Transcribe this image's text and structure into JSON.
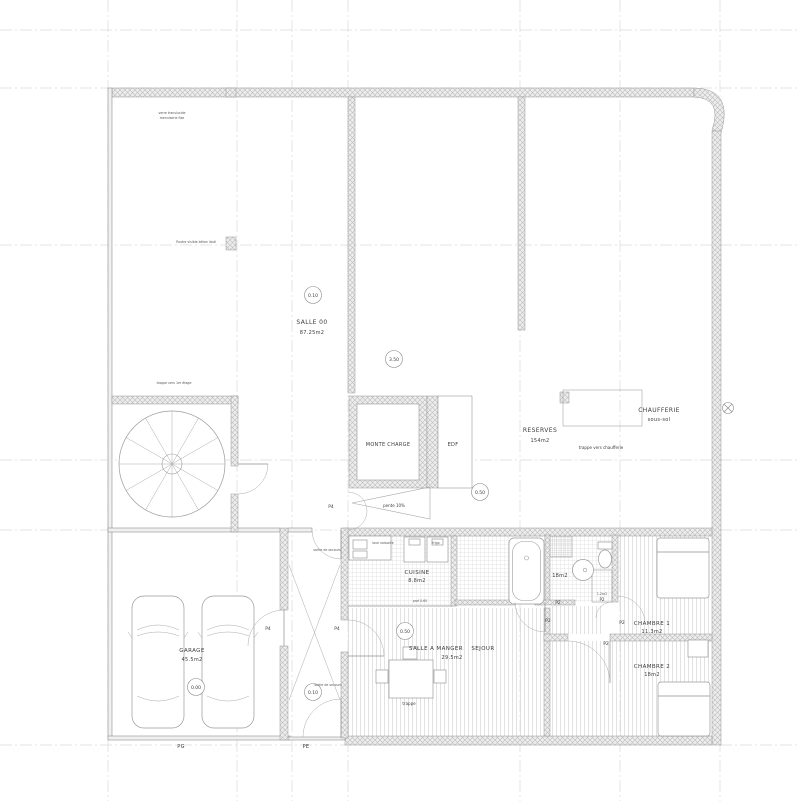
{
  "rooms": {
    "salle00": {
      "name": "SALLE 00",
      "area": "87.25m2"
    },
    "monte_charge": {
      "name": "MONTE CHARGE"
    },
    "edf": {
      "name": "EDF"
    },
    "reserves": {
      "name": "RESERVES",
      "area": "154m2"
    },
    "chaufferie": {
      "name": "CHAUFFERIE",
      "level": "sous-sol"
    },
    "garage": {
      "name": "GARAGE",
      "area": "45.5m2"
    },
    "cuisine": {
      "name": "CUISINE",
      "area": "8.8m2"
    },
    "salle_a_manger": {
      "name": "SALLE A MANGER",
      "name2": "SEJOUR",
      "area": "29.5m2"
    },
    "salle_de_bain": {
      "area": "18m2"
    },
    "wc": {
      "area": "1.2m2"
    },
    "chambre1": {
      "name": "CHAMBRE 1",
      "area": "11.3m2"
    },
    "chambre2": {
      "name": "CHAMBRE 2",
      "area": "18m2"
    }
  },
  "levels": {
    "salle00": "0.10",
    "etage": "3.50",
    "reserves": "0.50",
    "sejour": "0.50",
    "entree": "0.10",
    "garage": "0.00"
  },
  "doors": {
    "garage_door": "PG",
    "entry_door": "PE",
    "p4": "P4",
    "p2": "P2"
  },
  "notes": {
    "window": "verre translucide",
    "window2": "menuiserie fixe",
    "beam": "Poutre visible béton lissé",
    "stair_trap": "trappe vers 1er étage",
    "slope": "pente 10%",
    "boiler_trap": "trappe vers chaufferie",
    "emergency_exit": "sortie de secours",
    "floor_trap": "trappe",
    "dishwasher": "lave vaisselle",
    "fridge": "frigo",
    "counter_depth": "prof 0.60"
  }
}
